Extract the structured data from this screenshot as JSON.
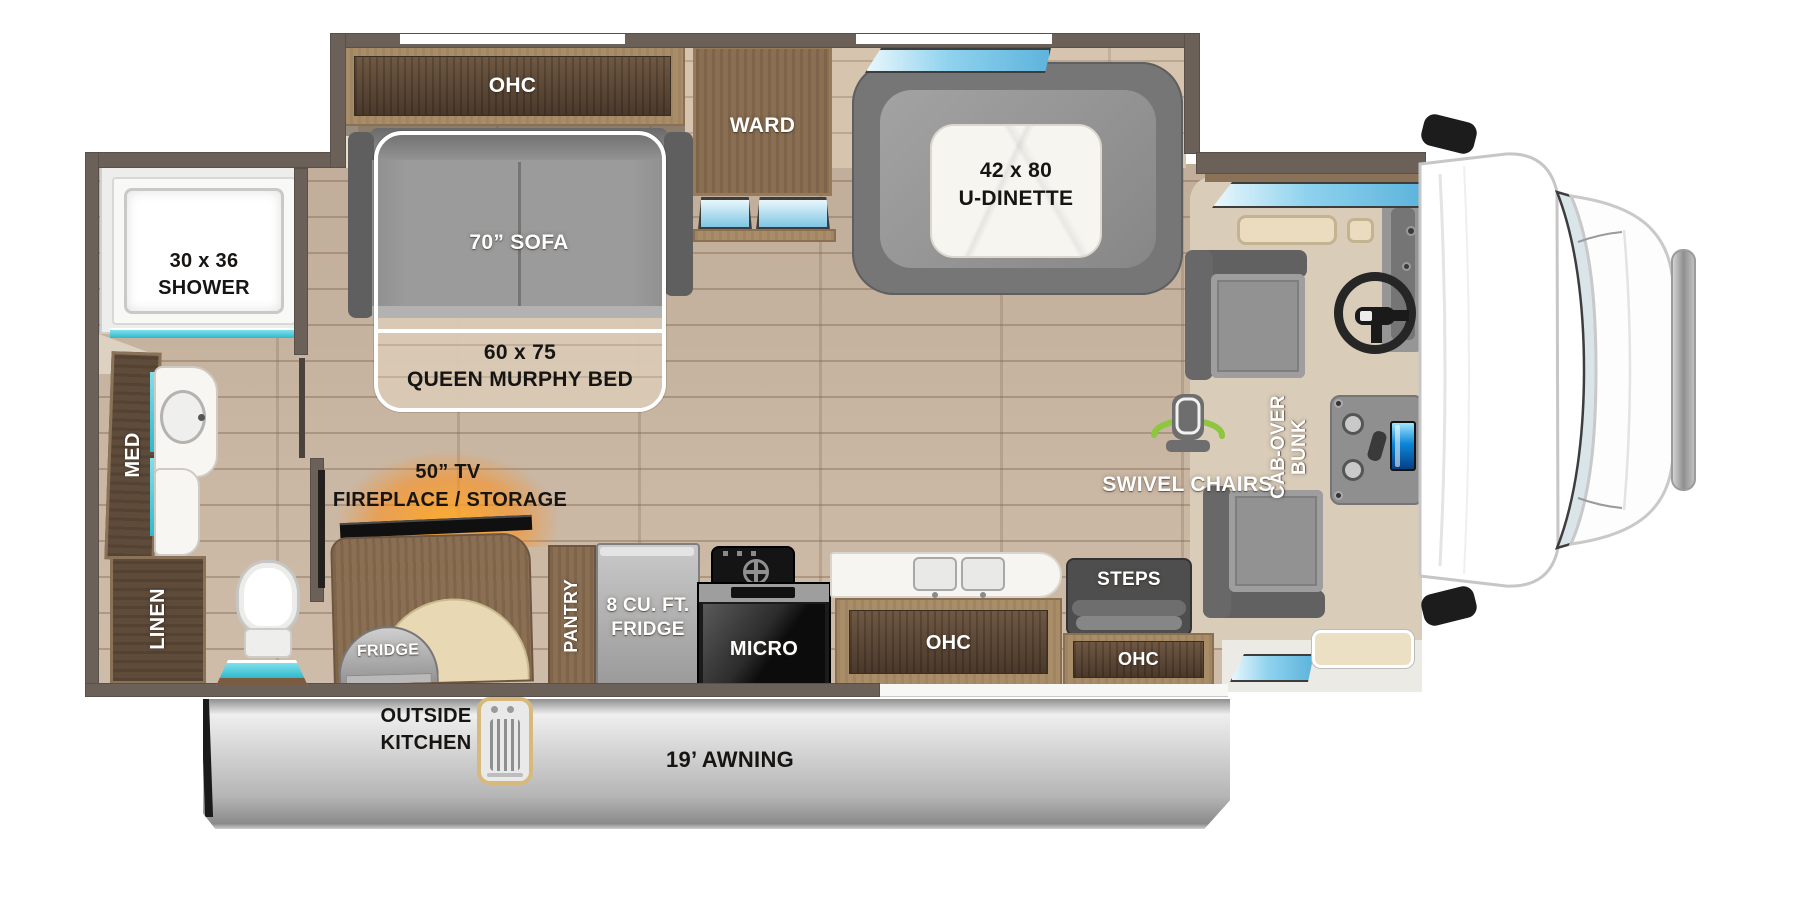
{
  "labels": {
    "bedroom_ohc": "OHC",
    "sofa": "70” SOFA",
    "murphy_line1": "60 x 75",
    "murphy_line2": "QUEEN MURPHY BED",
    "shower_line1": "30 x 36",
    "shower_line2": "SHOWER",
    "ward": "WARD",
    "dinette_line1": "42 x 80",
    "dinette_line2": "U-DINETTE",
    "med": "MED",
    "linen": "LINEN",
    "tv": "50” TV",
    "fireplace": "FIREPLACE / STORAGE",
    "outside_fridge": "FRIDGE",
    "pantry": "PANTRY",
    "fridge_line1": "8 CU. FT.",
    "fridge_line2": "FRIDGE",
    "micro": "MICRO",
    "kitchen_ohc": "OHC",
    "steps": "STEPS",
    "entry_ohc": "OHC",
    "swivel_chairs": "SWIVEL CHAIRS",
    "cab_over_line1": "CAB-OVER",
    "cab_over_line2": "BUNK",
    "outside_kitchen_line1": "OUTSIDE",
    "outside_kitchen_line2": "KITCHEN",
    "awning": "19’ AWNING"
  },
  "colors": {
    "wall": "#6b6159",
    "floor_wood": "#c9b5a0",
    "cab_floor_beige": "#d9ccb9",
    "window_glass_blue": "#8fd2ee",
    "shower_teal": "#2fb9cd",
    "swivel_green": "#8dc63f",
    "fireplace_glow": "#ffaa28",
    "awning_gray": "#c2c2c2",
    "furniture_gray": "#8f8f8f",
    "dark_wood": "#5f4b3a",
    "light_wood_frame": "#a98d68"
  }
}
